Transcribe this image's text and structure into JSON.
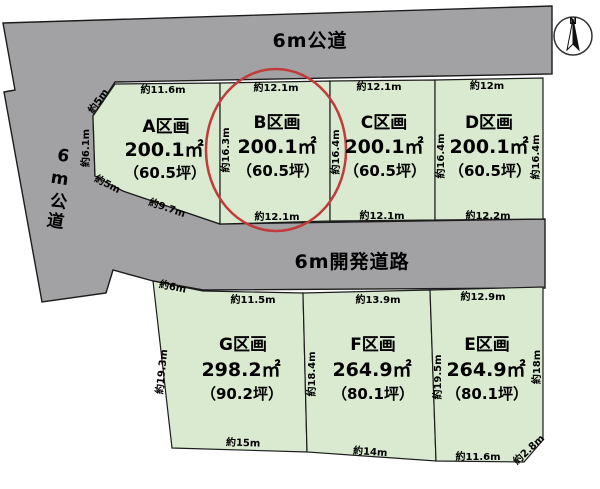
{
  "roads": {
    "top_label": "6m公道",
    "left_label": "6m公道",
    "middle_label": "6m開発道路"
  },
  "compass": {
    "north_label": "N"
  },
  "plots": {
    "A": {
      "name": "A区画",
      "area": "200.1㎡",
      "tsubo": "（60.5坪）"
    },
    "B": {
      "name": "B区画",
      "area": "200.1㎡",
      "tsubo": "（60.5坪）"
    },
    "C": {
      "name": "C区画",
      "area": "200.1㎡",
      "tsubo": "（60.5坪）"
    },
    "D": {
      "name": "D区画",
      "area": "200.1㎡",
      "tsubo": "（60.5坪）"
    },
    "G": {
      "name": "G区画",
      "area": "298.2㎡",
      "tsubo": "（90.2坪）"
    },
    "F": {
      "name": "F区画",
      "area": "264.9㎡",
      "tsubo": "（80.1坪）"
    },
    "E": {
      "name": "E区画",
      "area": "264.9㎡",
      "tsubo": "（80.1坪）"
    }
  },
  "dimensions": {
    "a_top": "約11.6m",
    "a_upper_left": "約5m",
    "a_left": "約6.1m",
    "a_lower_left": "約5m",
    "a_bottom": "約9.7m",
    "b_left": "約16.3m",
    "b_top": "約12.1m",
    "b_bottom": "約12.1m",
    "b_c_boundary": "約16.4m",
    "c_top": "約12.1m",
    "c_bottom": "約12.1m",
    "c_d_boundary": "約16.4m",
    "d_top": "約12m",
    "d_bottom": "約12.2m",
    "d_right": "約16.4m",
    "g_upper_left": "約6m",
    "g_top": "約11.5m",
    "g_left": "約19.3m",
    "g_bottom": "約15m",
    "g_f_boundary": "約18.4m",
    "f_top": "約13.9m",
    "f_bottom": "約14m",
    "f_e_boundary": "約19.5m",
    "e_top": "約12.9m",
    "e_right": "約18m",
    "e_bottom": "約11.6m",
    "e_bottom_right": "約2.8m"
  },
  "colors": {
    "road_gray": "#a2a2a5",
    "plot_green": "#d9ead0",
    "highlight_red": "#c23b3b"
  }
}
